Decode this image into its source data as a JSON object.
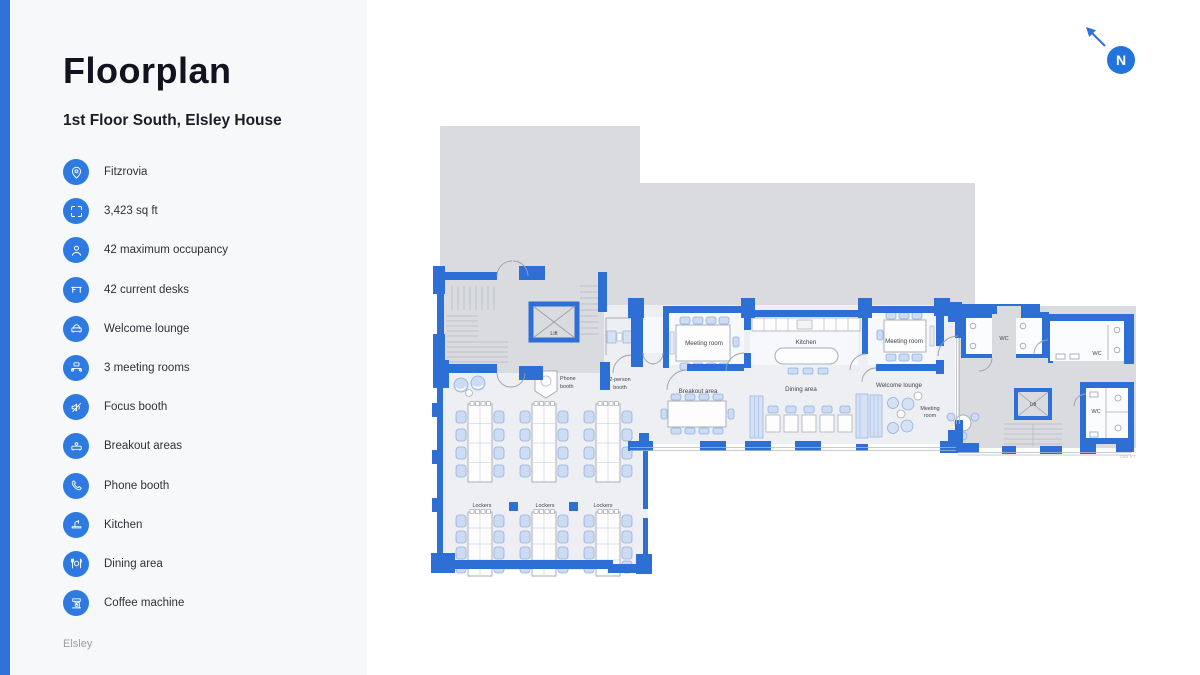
{
  "accent": "#2e72d9",
  "sidebar": {
    "title": "Floorplan",
    "subtitle": "1st Floor South, Elsley House",
    "items": [
      {
        "icon": "location-pin-icon",
        "label": "Fitzrovia"
      },
      {
        "icon": "area-brackets-icon",
        "label": "3,423 sq ft"
      },
      {
        "icon": "person-icon",
        "label": "42 maximum occupancy"
      },
      {
        "icon": "desk-icon",
        "label": "42 current desks"
      },
      {
        "icon": "lounge-sofa-icon",
        "label": "Welcome lounge"
      },
      {
        "icon": "meeting-table-icon",
        "label": "3 meeting rooms"
      },
      {
        "icon": "muted-speaker-icon",
        "label": "Focus booth"
      },
      {
        "icon": "breakout-sofa-icon",
        "label": "Breakout areas"
      },
      {
        "icon": "phone-icon",
        "label": "Phone booth"
      },
      {
        "icon": "kitchen-tap-icon",
        "label": "Kitchen"
      },
      {
        "icon": "dining-icon",
        "label": "Dining area"
      },
      {
        "icon": "coffee-machine-icon",
        "label": "Coffee machine"
      }
    ],
    "footer": "Elsley"
  },
  "compass": {
    "label": "N"
  },
  "floorplan": {
    "labels": {
      "lift_left": "Lift",
      "phone_l1": "Phone",
      "phone_l2": "booth",
      "booth2_l1": "2-person",
      "booth2_l2": "booth",
      "meeting_left": "Meeting room",
      "kitchen": "Kitchen",
      "meeting_right": "Meeting room",
      "breakout": "Breakout area",
      "dining": "Dining area",
      "welcome": "Welcome lounge",
      "meeting_small_l1": "Meeting",
      "meeting_small_l2": "room",
      "wc_a": "WC",
      "wc_b": "WC",
      "wc_c": "WC",
      "lift_right": "Lift",
      "lockers_a": "Lockers",
      "lockers_b": "Lockers",
      "lockers_c": "Lockers",
      "ref": "DIS VT"
    }
  }
}
